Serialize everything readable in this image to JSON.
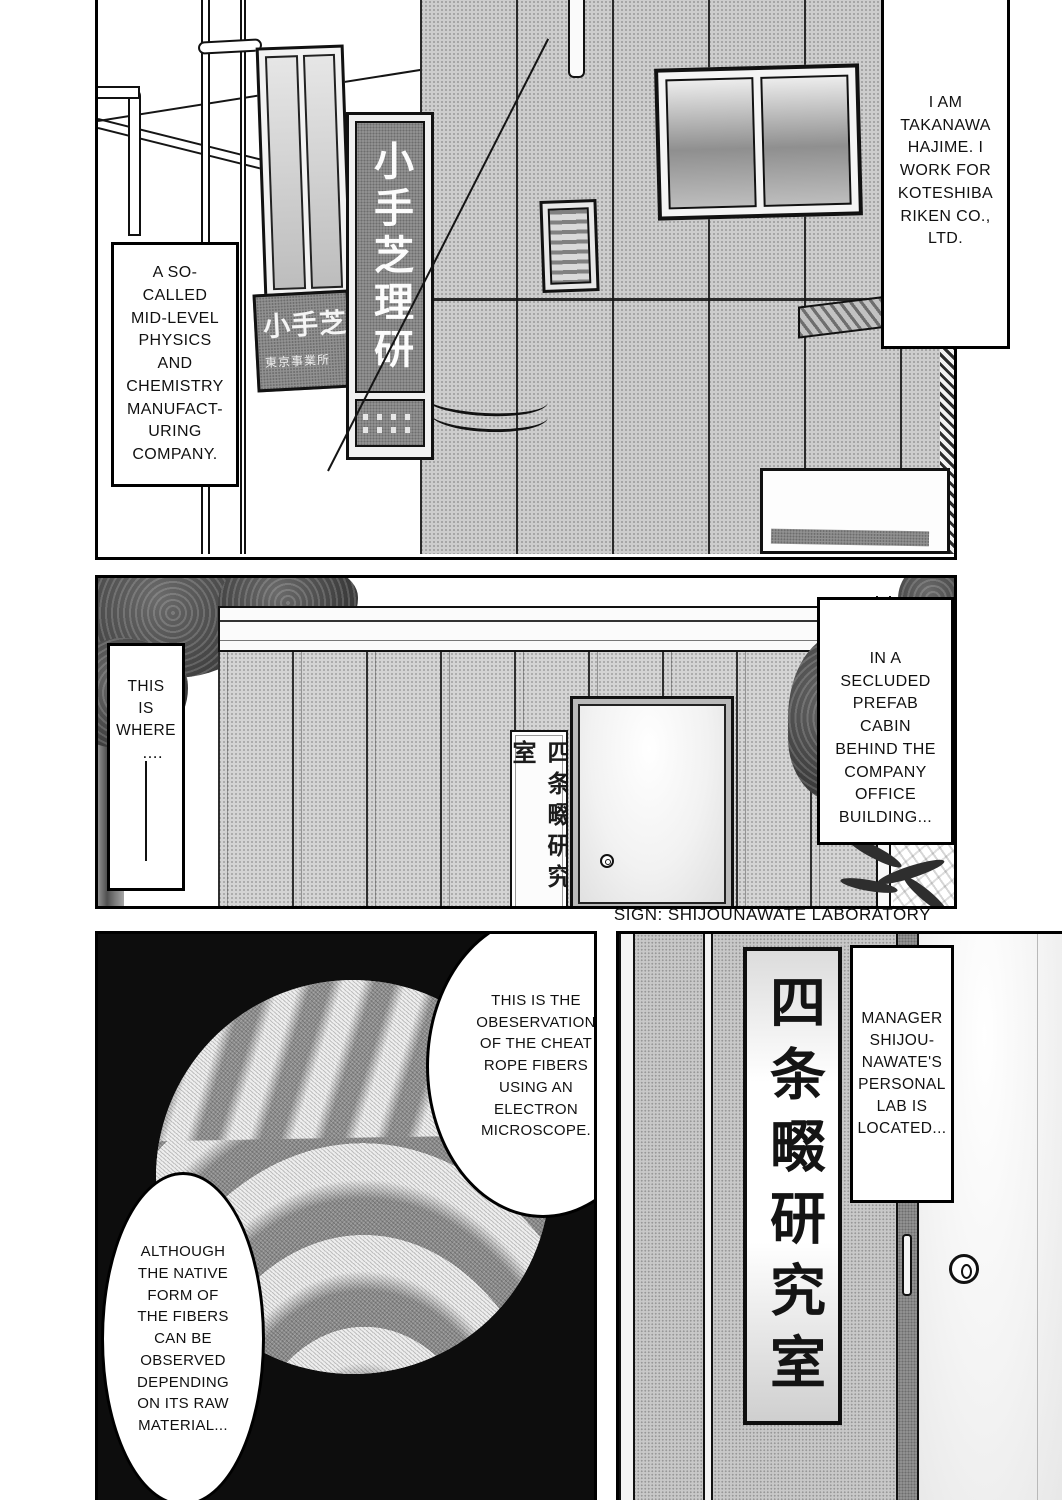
{
  "colors": {
    "ink": "#111111",
    "paper": "#ffffff",
    "wall_halftone": "#cfcfcf",
    "dark_board": "#929292",
    "panel3_background": "#0d0d0d"
  },
  "panel1": {
    "narration_right": "I AM\nTAKANAWA\nHAJIME. I\nWORK FOR\nKOTESHIBA\nRIKEN CO.,\nLTD.",
    "narration_left": "A SO-\nCALLED\nMID-LEVEL\nPHYSICS\nAND\nCHEMISTRY\nMANUFACT-\nURING\nCOMPANY.",
    "building_sign_vertical": "小手芝理研",
    "building_sign_small_title": "小手芝理研",
    "building_sign_small_subtitle": "東京事業所"
  },
  "panel2": {
    "narration_left": "THIS\nIS\nWHERE",
    "narration_left_ellipsis": "....",
    "narration_right": "IN A\nSECLUDED\nPREFAB\nCABIN\nBEHIND THE\nCOMPANY\nOFFICE\nBUILDING...",
    "door_sign_vertical": "四条畷研究室"
  },
  "caption": {
    "sign_translation": "SIGN: SHIJOUNAWATE LABORATORY"
  },
  "panel3": {
    "bubble_top": "THIS IS THE\nOBESERVATION\nOF THE CHEAT\nROPE FIBERS\nUSING AN\nELECTRON\nMICROSCOPE.",
    "bubble_bottom": "ALTHOUGH\nTHE NATIVE\nFORM OF\nTHE FIBERS\nCAN BE\nOBSERVED\nDEPENDING\nON ITS RAW\nMATERIAL..."
  },
  "panel4": {
    "lab_sign_vertical": "四条畷研究室",
    "narration": "MANAGER\nSHIJOU-\nNAWATE'S\nPERSONAL\nLAB IS\nLOCATED..."
  }
}
